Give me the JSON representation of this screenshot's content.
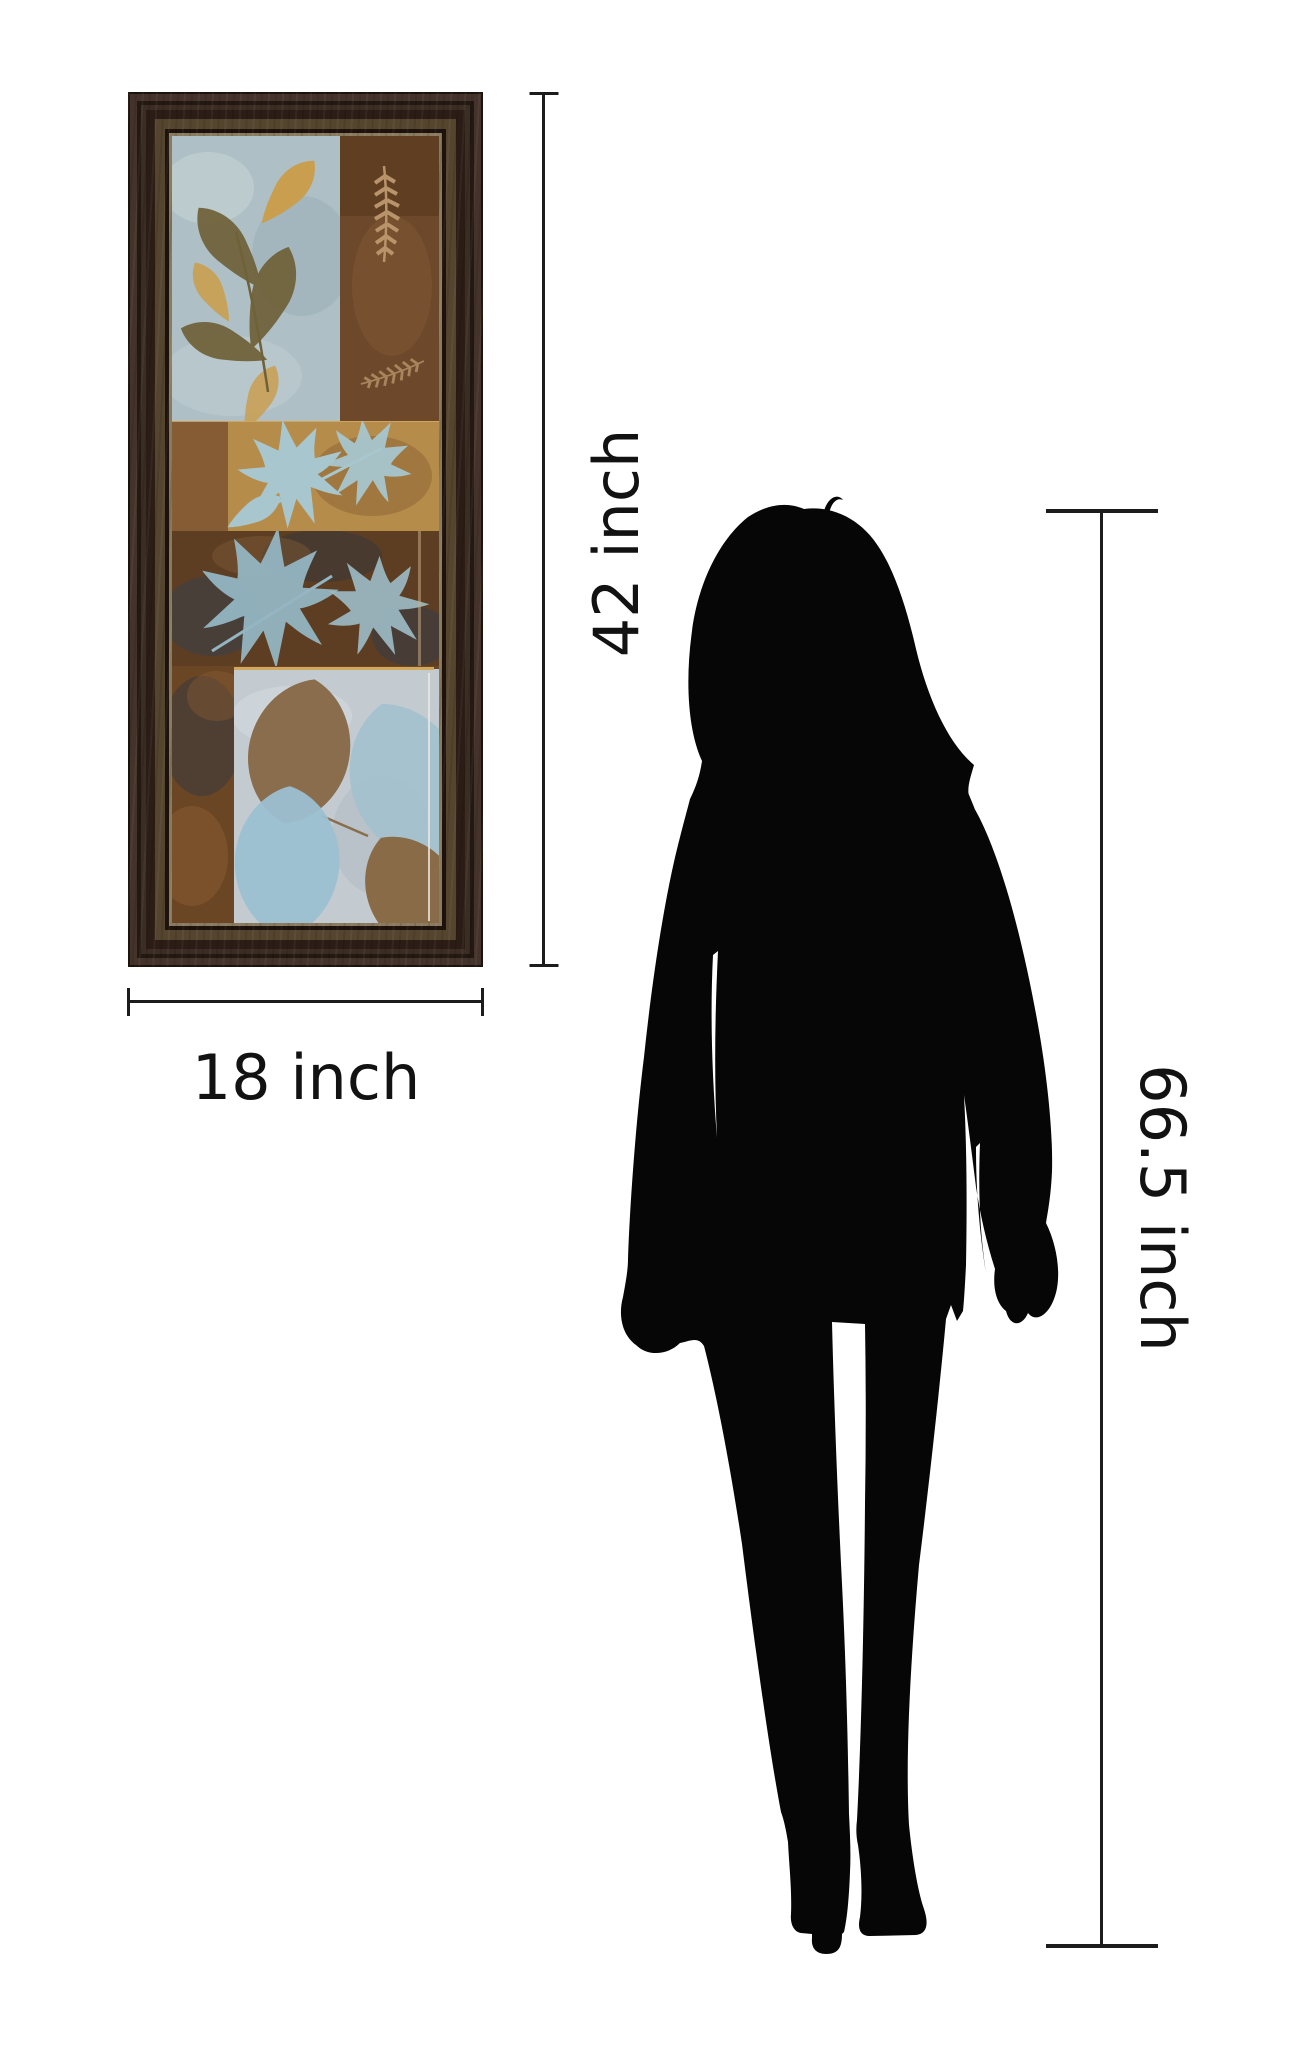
{
  "comparison": {
    "artwork": {
      "description": "framed leaf collage wall art print",
      "height_label": "42 inch",
      "width_label": "18 inch"
    },
    "person": {
      "description": "standing woman silhouette",
      "height_label": "66.5 inch"
    }
  },
  "colors": {
    "line": "#1c1c1c",
    "text": "#121212",
    "silhouette": "#060606",
    "frame_dark": "#1e130c",
    "frame_mid": "#38291d",
    "frame_light": "#55452f",
    "frame_liner": "#8a7a5f",
    "panel_blue": "#aec0c6",
    "panel_brown": "#6d482a",
    "panel_gold": "#b68c4a",
    "panel_rust": "#5d3e23",
    "panel_silver": "#c3cbd1",
    "leaf_olive": "#6f6138",
    "leaf_gold": "#c99e4e",
    "leaf_blue": "#a8c6ce",
    "leaf_brown": "#8a6d4c",
    "leaf_tan": "#b9946a",
    "accent_goldline": "#d2a85e",
    "navy_blotch": "#39404d"
  }
}
